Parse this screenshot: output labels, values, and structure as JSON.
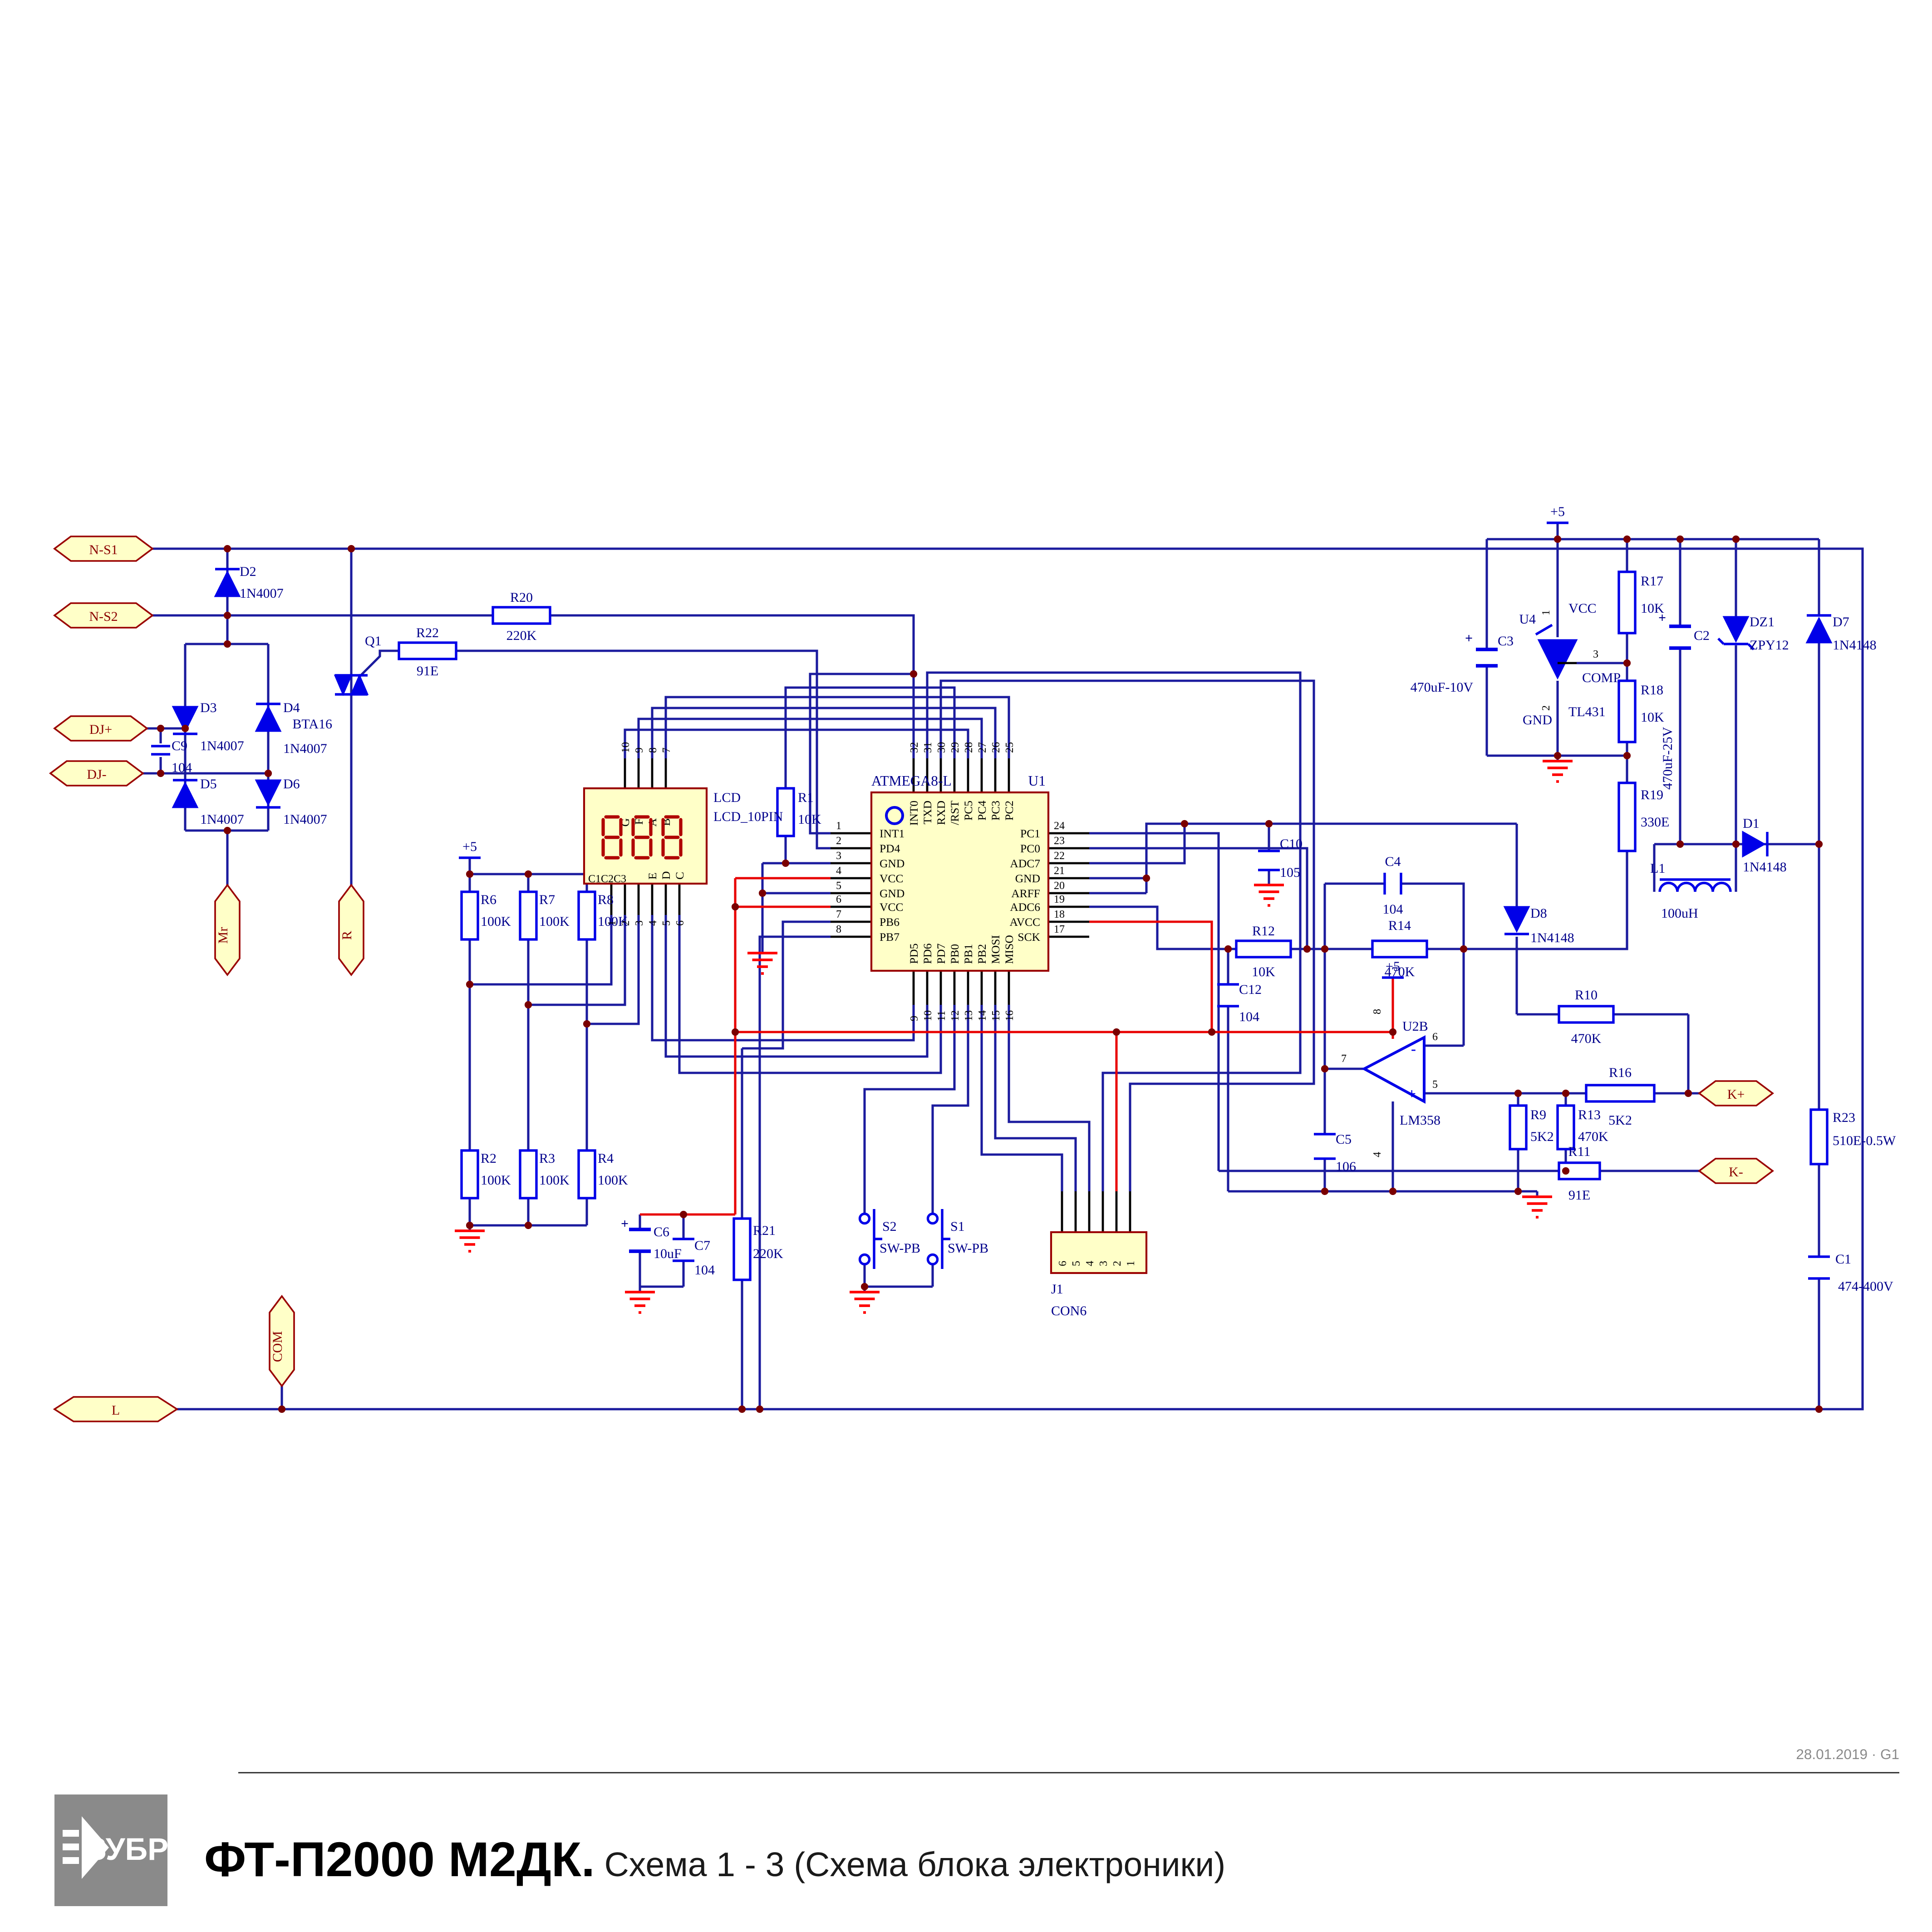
{
  "title_block": {
    "brand": "ЗУБР",
    "title_bold": "ФТ-П2000 М2ДК.",
    "title_rest": " Схема 1 - 3 (Схема блока электроники)",
    "rev": "28.01.2019 · G1"
  },
  "power": {
    "plus5": "+5"
  },
  "connectors": {
    "ns1": "N-S1",
    "ns2": "N-S2",
    "djp": "DJ+",
    "djm": "DJ-",
    "mr": "Mr",
    "r": "R",
    "com": "COM",
    "l": "L",
    "kp": "K+",
    "km": "K-"
  },
  "components": {
    "r1": {
      "ref": "R1",
      "val": "10K"
    },
    "r2": {
      "ref": "R2",
      "val": "100K"
    },
    "r3": {
      "ref": "R3",
      "val": "100K"
    },
    "r4": {
      "ref": "R4",
      "val": "100K"
    },
    "r6": {
      "ref": "R6",
      "val": "100K"
    },
    "r7": {
      "ref": "R7",
      "val": "100K"
    },
    "r8": {
      "ref": "R8",
      "val": "100K"
    },
    "r9": {
      "ref": "R9",
      "val": "5K2"
    },
    "r10": {
      "ref": "R10",
      "val": "470K"
    },
    "r11": {
      "ref": "R11",
      "val": "91E"
    },
    "r12": {
      "ref": "R12",
      "val": "10K"
    },
    "r13": {
      "ref": "R13",
      "val": "470K"
    },
    "r14": {
      "ref": "R14",
      "val": "470K"
    },
    "r16": {
      "ref": "R16",
      "val": "5K2"
    },
    "r17": {
      "ref": "R17",
      "val": "10K"
    },
    "r18": {
      "ref": "R18",
      "val": "10K"
    },
    "r19": {
      "ref": "R19",
      "val": "330E"
    },
    "r20": {
      "ref": "R20",
      "val": "220K"
    },
    "r21": {
      "ref": "R21",
      "val": "220K"
    },
    "r22": {
      "ref": "R22",
      "val": "91E"
    },
    "r23": {
      "ref": "R23",
      "val": "510E-0.5W"
    },
    "c1": {
      "ref": "C1",
      "val": "474-400V"
    },
    "c2": {
      "ref": "C2",
      "val": "470uF-25V"
    },
    "c3": {
      "ref": "C3",
      "val": "470uF-10V"
    },
    "c4": {
      "ref": "C4",
      "val": "104"
    },
    "c5": {
      "ref": "C5",
      "val": "106"
    },
    "c6": {
      "ref": "C6",
      "val": "10uF"
    },
    "c7": {
      "ref": "C7",
      "val": "104"
    },
    "c9": {
      "ref": "C9",
      "val": "104"
    },
    "c10": {
      "ref": "C10",
      "val": "105"
    },
    "c12": {
      "ref": "C12",
      "val": "104"
    },
    "d1": {
      "ref": "D1",
      "val": "1N4148"
    },
    "d2": {
      "ref": "D2",
      "val": "1N4007"
    },
    "d3": {
      "ref": "D3",
      "val": "1N4007"
    },
    "d4": {
      "ref": "D4",
      "val": "1N4007"
    },
    "d5": {
      "ref": "D5",
      "val": "1N4007"
    },
    "d6": {
      "ref": "D6",
      "val": "1N4007"
    },
    "d7": {
      "ref": "D7",
      "val": "1N4148"
    },
    "d8": {
      "ref": "D8",
      "val": "1N4148"
    },
    "dz1": {
      "ref": "DZ1",
      "val": "ZPY12"
    },
    "l1": {
      "ref": "L1",
      "val": "100uH"
    },
    "q1": {
      "ref": "Q1",
      "val": "BTA16"
    }
  },
  "ic": {
    "name": "ATMEGA8-L",
    "ref": "U1",
    "left": [
      {
        "n": "1",
        "l": "INT1"
      },
      {
        "n": "2",
        "l": "PD4"
      },
      {
        "n": "3",
        "l": "GND"
      },
      {
        "n": "4",
        "l": "VCC"
      },
      {
        "n": "5",
        "l": "GND"
      },
      {
        "n": "6",
        "l": "VCC"
      },
      {
        "n": "7",
        "l": "PB6"
      },
      {
        "n": "8",
        "l": "PB7"
      }
    ],
    "right": [
      {
        "n": "24",
        "l": "PC1"
      },
      {
        "n": "23",
        "l": "PC0"
      },
      {
        "n": "22",
        "l": "ADC7"
      },
      {
        "n": "21",
        "l": "GND"
      },
      {
        "n": "20",
        "l": "ARFF"
      },
      {
        "n": "19",
        "l": "ADC6"
      },
      {
        "n": "18",
        "l": "AVCC"
      },
      {
        "n": "17",
        "l": "SCK"
      }
    ],
    "top": [
      {
        "n": "32",
        "l": "INT0"
      },
      {
        "n": "31",
        "l": "TXD"
      },
      {
        "n": "30",
        "l": "RXD"
      },
      {
        "n": "29",
        "l": "/RST"
      },
      {
        "n": "28",
        "l": "PC5"
      },
      {
        "n": "27",
        "l": "PC4"
      },
      {
        "n": "26",
        "l": "PC3"
      },
      {
        "n": "25",
        "l": "PC2"
      }
    ],
    "bottom": [
      {
        "n": "9",
        "l": "PD5"
      },
      {
        "n": "10",
        "l": "PD6"
      },
      {
        "n": "11",
        "l": "PD7"
      },
      {
        "n": "12",
        "l": "PB0"
      },
      {
        "n": "13",
        "l": "PB1"
      },
      {
        "n": "14",
        "l": "PB2"
      },
      {
        "n": "15",
        "l": "MOSI"
      },
      {
        "n": "16",
        "l": "MISO"
      }
    ]
  },
  "lcd": {
    "name": "LCD",
    "type": "LCD_10PIN",
    "display": "888",
    "top_pins": [
      "10",
      "9",
      "8",
      "7"
    ],
    "top_letters": [
      "G",
      "F",
      "A",
      "B"
    ],
    "bottom_pins": [
      "1",
      "2",
      "3",
      "4",
      "5",
      "6"
    ],
    "bottom_group": "C1C2C3",
    "bottom_letters": [
      "E",
      "D",
      "C"
    ]
  },
  "opamp": {
    "ref": "U2B",
    "part": "LM358",
    "out": "7",
    "inv": "6",
    "nin": "5",
    "vcc": "8",
    "gnd": "4",
    "minus": "-",
    "plus": "+"
  },
  "u4": {
    "ref": "U4",
    "part": "TL431",
    "p1": "1",
    "p2": "2",
    "p3": "3",
    "vcc": "VCC",
    "gnd": "GND",
    "comp": "COMP"
  },
  "j1": {
    "ref": "J1",
    "type": "CON6",
    "pins": [
      "6",
      "5",
      "4",
      "3",
      "2",
      "1"
    ]
  },
  "switches": {
    "s2": {
      "ref": "S2",
      "type": "SW-PB"
    },
    "s1": {
      "ref": "S1",
      "type": "SW-PB"
    }
  },
  "colors": {
    "wire": "#1b1b9e",
    "component": "#0000e8",
    "junction": "#7a0000",
    "connector_fill": "#ffffc8",
    "gnd": "#ff0000",
    "red_wire": "#e80000"
  }
}
